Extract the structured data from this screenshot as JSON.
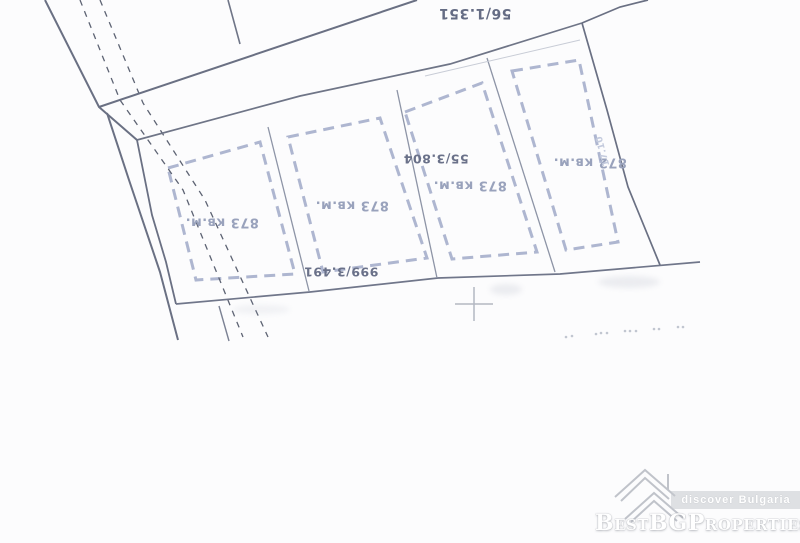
{
  "page": {
    "background": "#fcfcfd"
  },
  "watermark": {
    "brand": "BestBGProperties",
    "tagline": "discover Bulgaria"
  },
  "map": {
    "width": 800,
    "height": 543,
    "plot_style": {
      "stroke": "#a5aecb",
      "width": 3,
      "dash": "11 7"
    },
    "plots": [
      {
        "name": "plot-1",
        "area_label": "873 кв.м.",
        "points": [
          [
            168,
            168
          ],
          [
            260,
            142
          ],
          [
            295,
            274
          ],
          [
            196,
            280
          ]
        ]
      },
      {
        "name": "plot-2",
        "area_label": "873 кв.м.",
        "points": [
          [
            288,
            137
          ],
          [
            380,
            118
          ],
          [
            427,
            258
          ],
          [
            323,
            272
          ]
        ]
      },
      {
        "name": "plot-3",
        "area_label": "873 кв.м.",
        "points": [
          [
            405,
            112
          ],
          [
            482,
            83
          ],
          [
            537,
            252
          ],
          [
            452,
            259
          ]
        ]
      },
      {
        "name": "plot-4",
        "area_label": "872 кв.м.",
        "points": [
          [
            512,
            71
          ],
          [
            579,
            60
          ],
          [
            618,
            242
          ],
          [
            566,
            250
          ]
        ]
      }
    ],
    "solid_lines": [
      {
        "name": "road-edge-upper",
        "points": [
          [
            45,
            0
          ],
          [
            99,
            107
          ],
          [
            137,
            140
          ]
        ],
        "w": 2,
        "c": "#6a7083"
      },
      {
        "name": "road-edge-lower",
        "points": [
          [
            107,
            113
          ],
          [
            129,
            180
          ],
          [
            160,
            272
          ],
          [
            178,
            340
          ]
        ],
        "w": 2,
        "c": "#6a7083"
      },
      {
        "name": "parcels-left-boundary",
        "points": [
          [
            137,
            140
          ],
          [
            152,
            215
          ],
          [
            166,
            262
          ],
          [
            176,
            304
          ]
        ],
        "w": 1.8,
        "c": "#6a7083"
      },
      {
        "name": "upper-parcel-boundary",
        "points": [
          [
            99,
            107
          ],
          [
            417,
            0
          ]
        ],
        "w": 2,
        "c": "#6a7083"
      },
      {
        "name": "upper-parcel-division",
        "points": [
          [
            228,
            0
          ],
          [
            240,
            44
          ]
        ],
        "w": 1.6,
        "c": "#6f7587"
      },
      {
        "name": "parcels-top-boundary",
        "points": [
          [
            137,
            140
          ],
          [
            300,
            96
          ],
          [
            450,
            64
          ],
          [
            582,
            23
          ]
        ],
        "w": 1.7,
        "c": "#6f7587"
      },
      {
        "name": "boundary-to-top-edge",
        "points": [
          [
            582,
            23
          ],
          [
            620,
            7
          ],
          [
            648,
            0
          ]
        ],
        "w": 1.7,
        "c": "#6a7083"
      },
      {
        "name": "parcels-right-boundary",
        "points": [
          [
            582,
            23
          ],
          [
            607,
            110
          ],
          [
            628,
            187
          ],
          [
            660,
            265
          ]
        ],
        "w": 1.7,
        "c": "#6a7083"
      },
      {
        "name": "parcels-bottom-boundary",
        "points": [
          [
            176,
            304
          ],
          [
            310,
            292
          ],
          [
            438,
            278
          ],
          [
            560,
            274
          ],
          [
            700,
            262
          ]
        ],
        "w": 1.7,
        "c": "#70768a"
      },
      {
        "name": "stub-line",
        "points": [
          [
            219,
            306
          ],
          [
            229,
            341
          ]
        ],
        "w": 1.4,
        "c": "#7b8193"
      },
      {
        "name": "plot-division-1",
        "points": [
          [
            268,
            127
          ],
          [
            309,
            291
          ]
        ],
        "w": 1.3,
        "c": "#8d94a6"
      },
      {
        "name": "plot-division-2",
        "points": [
          [
            397,
            90
          ],
          [
            437,
            278
          ]
        ],
        "w": 1.3,
        "c": "#8d94a6"
      },
      {
        "name": "plot-division-3",
        "points": [
          [
            487,
            58
          ],
          [
            555,
            272
          ]
        ],
        "w": 1.3,
        "c": "#8d94a6"
      },
      {
        "name": "strip-faint-line",
        "points": [
          [
            425,
            76
          ],
          [
            580,
            40
          ]
        ],
        "w": 1,
        "c": "#c8ccd6"
      }
    ],
    "footpath_style": {
      "stroke": "#5d6373",
      "width": 1.3,
      "dash": "6 6"
    },
    "footpath_lines": [
      {
        "name": "footpath-dash-left",
        "points": [
          [
            80,
            0
          ],
          [
            120,
            100
          ],
          [
            183,
            190
          ],
          [
            243,
            337
          ]
        ]
      },
      {
        "name": "footpath-dash-right",
        "points": [
          [
            100,
            0
          ],
          [
            143,
            103
          ],
          [
            205,
            200
          ],
          [
            268,
            337
          ]
        ]
      }
    ],
    "labels": [
      {
        "name": "parcel-number-56-1-351",
        "text": "56/1.351",
        "x": 475,
        "y": 13,
        "size": 14,
        "color": "#656c84",
        "rot": 180
      },
      {
        "name": "parcel-number-55-3-804",
        "text": "55/3.804",
        "x": 436,
        "y": 158,
        "size": 12.5,
        "color": "#6a7189",
        "rot": 180
      },
      {
        "name": "parcel-number-999-3-491",
        "text": "999/3.491",
        "x": 341,
        "y": 271,
        "size": 12.5,
        "color": "#6a7189",
        "rot": 180
      },
      {
        "name": "plot-1-area-label",
        "text": "873 кв.м.",
        "x": 222,
        "y": 222,
        "size": 13,
        "color": "#99a2bc",
        "rot": 180
      },
      {
        "name": "plot-2-area-label",
        "text": "873 кв.м.",
        "x": 352,
        "y": 205,
        "size": 13,
        "color": "#99a2bc",
        "rot": 180
      },
      {
        "name": "plot-3-area-label",
        "text": "873 кв.м.",
        "x": 470,
        "y": 185,
        "size": 13,
        "color": "#99a2bc",
        "rot": 180
      },
      {
        "name": "plot-4-area-label",
        "text": "872 кв.м.",
        "x": 590,
        "y": 162,
        "size": 13,
        "color": "#99a2bc",
        "rot": 180
      },
      {
        "name": "dimension-label-17-10",
        "text": "17.10",
        "x": 603,
        "y": 151,
        "size": 9,
        "color": "#c3cadd",
        "rot": 255
      }
    ],
    "cross": {
      "x": 474,
      "y": 304,
      "arm_h": 19,
      "arm_v": 17,
      "color": "#b3b8c2",
      "width": 1.5
    },
    "dots_style": {
      "r": 1.3,
      "color": "#9aa2b2",
      "opacity": 0.6
    },
    "dots": [
      [
        566,
        337
      ],
      [
        572,
        336
      ],
      [
        596,
        334
      ],
      [
        601,
        333
      ],
      [
        607,
        333
      ],
      [
        625,
        331
      ],
      [
        630,
        331
      ],
      [
        636,
        331
      ],
      [
        654,
        329
      ],
      [
        659,
        329
      ],
      [
        678,
        327
      ],
      [
        683,
        327
      ]
    ]
  }
}
